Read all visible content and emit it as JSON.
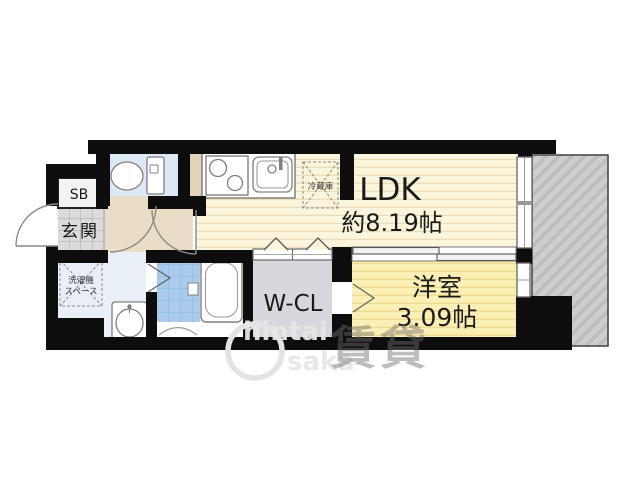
{
  "floorplan": {
    "rooms": {
      "ldk": {
        "name": "LDK",
        "size": "約8.19帖"
      },
      "bedroom": {
        "name": "洋室",
        "size": "3.09帖"
      },
      "walk_in_closet": {
        "name": "W-CL"
      },
      "entrance": {
        "name": "玄関"
      },
      "shoe_box": {
        "name": "SB"
      },
      "laundry_space": {
        "line1": "洗濯機",
        "line2": "スペース"
      },
      "refrigerator": {
        "name": "冷蔵庫"
      }
    },
    "watermark": {
      "line1": "hintai",
      "line2": "saka",
      "kanji": "賃貸"
    },
    "colors": {
      "wall": "#0d0d0d",
      "ldk_floor": "#FAF5DB",
      "ldk_stripe": "#EADFB9",
      "bedroom_floor": "#FBEFB5",
      "bedroom_stripe": "#EBDC92",
      "wcl": "#DAD6DD",
      "toilet_room": "#DCE9F4",
      "bath_tile": "#AACBEC",
      "washroom": "#E9EFF7",
      "hallway": "#EADDC5",
      "storage_block": "#E2D4BB",
      "genkan_tile": "#DBDBDB",
      "shoe_box_fill": "#F3F3F3",
      "balcony": "#CECECE",
      "fixture_stroke": "#808080"
    }
  }
}
